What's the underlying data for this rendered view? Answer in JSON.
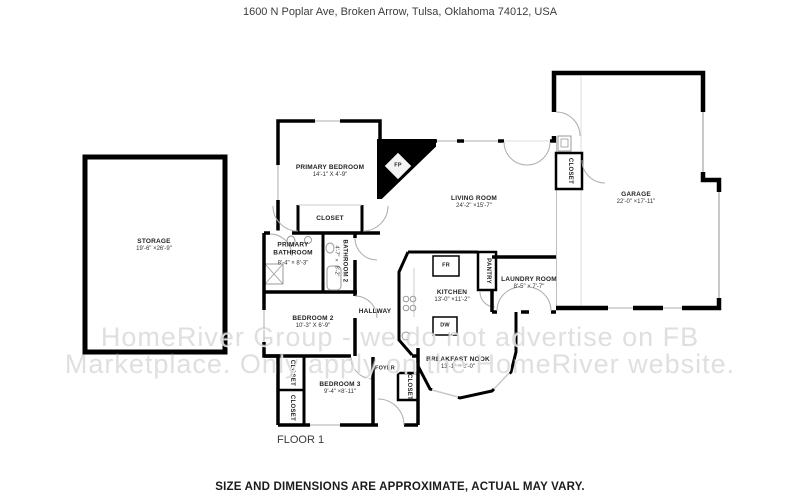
{
  "header": {
    "address": "1600 N Poplar Ave, Broken Arrow, Tulsa, Oklahoma 74012, USA"
  },
  "footer": {
    "disclaimer": "SIZE AND DIMENSIONS ARE APPROXIMATE, ACTUAL MAY VARY."
  },
  "floor_label": "FLOOR 1",
  "watermark": {
    "line1": "HomeRiver Group - we do not advertise on FB",
    "line2": "Marketplace. Only apply on the HomeRiver website."
  },
  "rooms": {
    "storage": {
      "name": "STORAGE",
      "dims": "19'-6\" ×26'-9\""
    },
    "primary_bedroom": {
      "name": "PRIMARY BEDROOM",
      "dims": "14'-1\" X 4'-9\""
    },
    "primary_closet": {
      "name": "CLOSET"
    },
    "primary_bathroom": {
      "name": "PRIMARY BATHROOM",
      "dims": "8'-4\" × 8'-3\""
    },
    "bathroom2": {
      "name": "BATHROOM 2",
      "dims": "4'-7\" × 8'-2\""
    },
    "bedroom2": {
      "name": "BEDROOM 2",
      "dims": "10'-3\" X 6'-9\""
    },
    "hallway": {
      "name": "HALLWAY"
    },
    "living_room": {
      "name": "LIVING ROOM",
      "dims": "24'-2\" ×15'-7\""
    },
    "kitchen": {
      "name": "KITCHEN",
      "dims": "13'-0\" ×11'-2\""
    },
    "pantry": {
      "name": "PANTRY"
    },
    "laundry_room": {
      "name": "LAUNDRY ROOM",
      "dims": "8'-5\" × 7'-7\""
    },
    "breakfast_nook": {
      "name": "BREAKFAST NOOK",
      "dims": "13'-1\" × 8'-0\""
    },
    "foyer": {
      "name": "FOYER"
    },
    "foyer_closet": {
      "name": "CLOSET"
    },
    "bedroom3": {
      "name": "BEDROOM 3",
      "dims": "9'-4\" ×8'-11\""
    },
    "bedroom3_closet_a": {
      "name": "CLOSET"
    },
    "bedroom3_closet_b": {
      "name": "CLOSET"
    },
    "garage": {
      "name": "GARAGE",
      "dims": "22'-0\" ×17'-11\""
    },
    "garage_closet": {
      "name": "CLOSET"
    }
  },
  "fixtures": {
    "fireplace": "FP",
    "fridge": "FR",
    "dishwasher": "DW"
  },
  "colors": {
    "wall": "#000000",
    "window": "#c9c9c9",
    "door_arc": "#adadad",
    "watermark": "#aaaaaa"
  }
}
